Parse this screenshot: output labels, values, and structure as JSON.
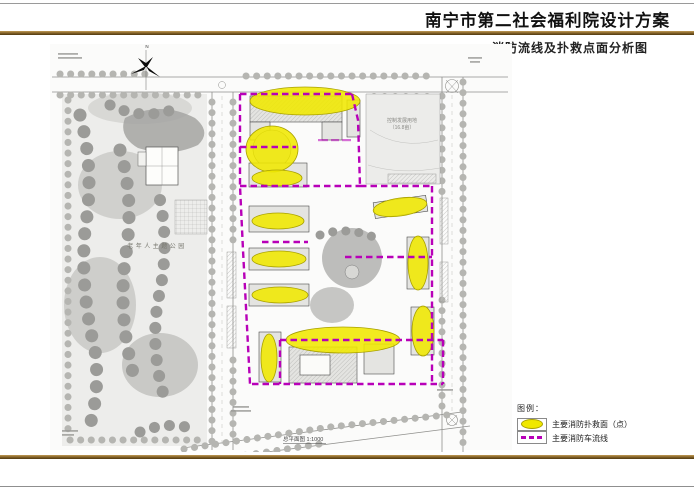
{
  "header": {
    "title": "南宁市第二社会福利院设计方案",
    "subtitle": "消防流线及扑救点面分析图"
  },
  "map": {
    "north_label": "N",
    "park_label": "老年人主题公园",
    "future_land_label_line1": "控制发展用地",
    "future_land_label_line2": "（16.8亩）",
    "caption": "总平面图 1:1000"
  },
  "legend": {
    "title": "图例：",
    "items": [
      {
        "symbol": "yellow-ellipse",
        "label": "主要消防扑救面（点）"
      },
      {
        "symbol": "magenta-dashed-line",
        "label": "主要消防车流线"
      }
    ]
  },
  "colors": {
    "accent_brown": "#8a652e",
    "rescue_yellow": "#f0e800",
    "route_magenta": "#b800b8"
  }
}
